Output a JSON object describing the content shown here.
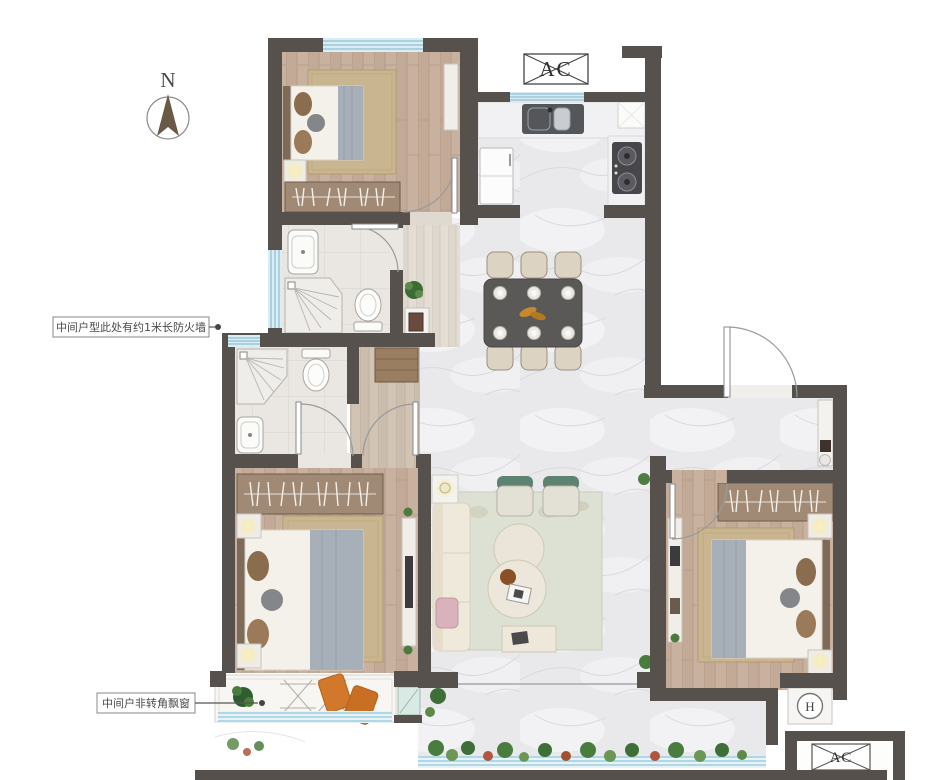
{
  "compass": {
    "label": "N"
  },
  "badges": {
    "ac_top": "AC",
    "ac_bottom": "AC",
    "water_heater": "H"
  },
  "annotations": {
    "firewall": "中间户型此处有约1米长防火墙",
    "bay_window": "中间户非转角飘窗"
  },
  "palette": {
    "wall": "#56514D",
    "window_blue": "#D8EDF4",
    "window_line": "#7FB4C9",
    "wood_floor": "#C3AA97",
    "marble_floor": "#E9E9EC",
    "bath_floor": "#EAE7E3",
    "rug_tan": "#C9B691",
    "rug_green": "#DCE1D3",
    "dining_table": "#5B5957",
    "sofa_cream": "#EFE9DC",
    "accent_orange": "#D2782A",
    "plant_green": "#4A7C3F",
    "lamp_glow": "#F6EEC0"
  }
}
